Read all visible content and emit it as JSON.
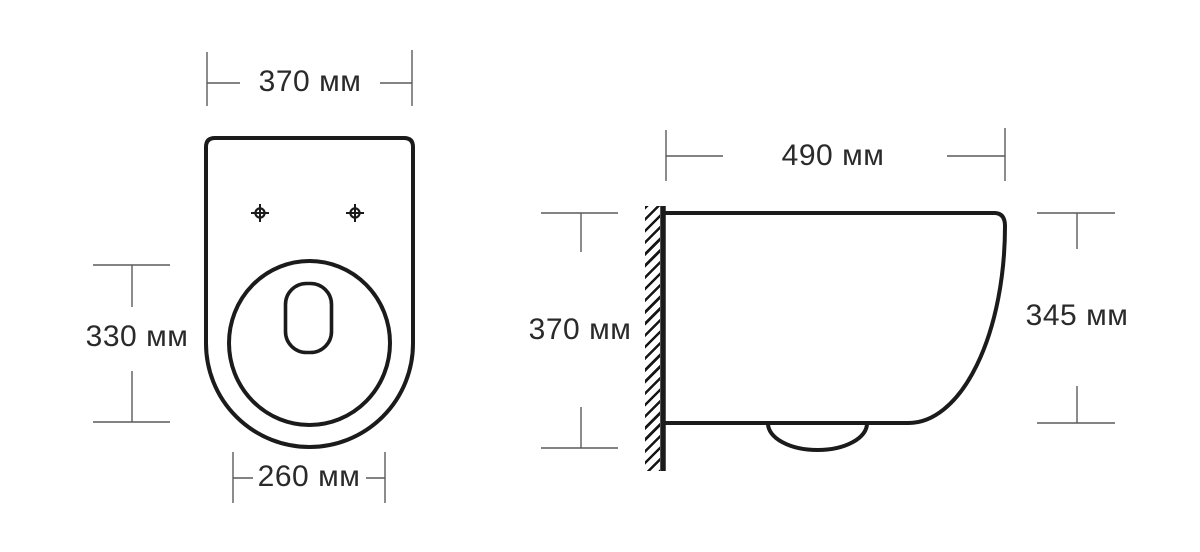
{
  "page": {
    "background_color": "#ffffff"
  },
  "drawing": {
    "kind": "technical dimension drawing",
    "subject": "wall-hung toilet, plan view and side view",
    "units": "мм",
    "colors": {
      "outline": "#1b1b1b",
      "dimension_lines": "#5a5a5a",
      "label_text": "#2a2a2a"
    },
    "front_view": {
      "overall_width": {
        "label": "370 мм",
        "value": 370
      },
      "bowl_length": {
        "label": "330 мм",
        "value": 330
      },
      "bowl_width": {
        "label": "260 мм",
        "value": 260
      }
    },
    "side_view": {
      "depth": {
        "label": "490 мм",
        "value": 490
      },
      "wall_side_height": {
        "label": "370 мм",
        "value": 370
      },
      "front_height": {
        "label": "345 мм",
        "value": 345
      }
    }
  }
}
